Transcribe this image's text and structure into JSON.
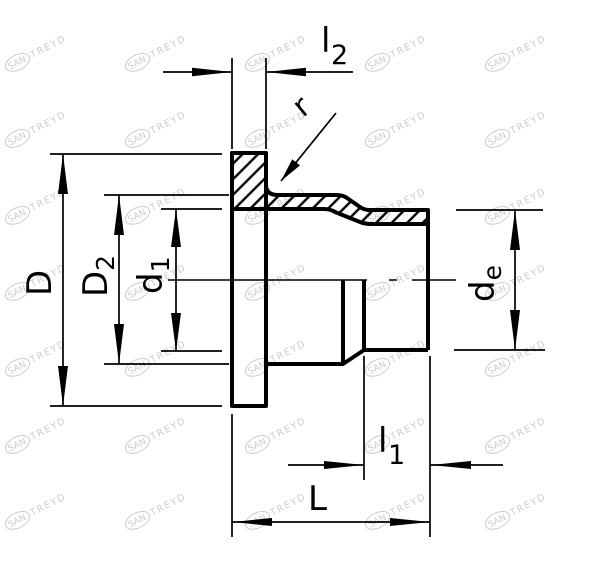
{
  "drawing": {
    "type": "technical-dimension-drawing",
    "subject": "flange-adapter-stub-end-cross-section",
    "line_color": "#000000",
    "background_color": "#ffffff",
    "labels": {
      "D": "D",
      "D2": {
        "main": "D",
        "sub": "2"
      },
      "d1": {
        "main": "d",
        "sub": "1"
      },
      "de": {
        "main": "d",
        "sub": "e"
      },
      "l2": {
        "main": "l",
        "sub": "2"
      },
      "l1": {
        "main": "l",
        "sub": "1"
      },
      "L": "L",
      "r": "r"
    }
  },
  "watermark": {
    "text_primary": "SAN",
    "text_secondary": "TREYD",
    "color": "#cccccc",
    "rotation": -27,
    "positions": [
      [
        30,
        56
      ],
      [
        150,
        56
      ],
      [
        270,
        56
      ],
      [
        390,
        56
      ],
      [
        510,
        56
      ],
      [
        30,
        132
      ],
      [
        150,
        132
      ],
      [
        270,
        132
      ],
      [
        390,
        132
      ],
      [
        510,
        132
      ],
      [
        30,
        209
      ],
      [
        150,
        209
      ],
      [
        270,
        209
      ],
      [
        390,
        209
      ],
      [
        510,
        209
      ],
      [
        30,
        285
      ],
      [
        150,
        285
      ],
      [
        270,
        285
      ],
      [
        390,
        285
      ],
      [
        510,
        285
      ],
      [
        30,
        361
      ],
      [
        150,
        361
      ],
      [
        270,
        361
      ],
      [
        390,
        361
      ],
      [
        510,
        361
      ],
      [
        30,
        438
      ],
      [
        150,
        438
      ],
      [
        270,
        438
      ],
      [
        390,
        438
      ],
      [
        510,
        438
      ],
      [
        30,
        514
      ],
      [
        150,
        514
      ],
      [
        270,
        514
      ],
      [
        390,
        514
      ],
      [
        510,
        514
      ]
    ]
  }
}
